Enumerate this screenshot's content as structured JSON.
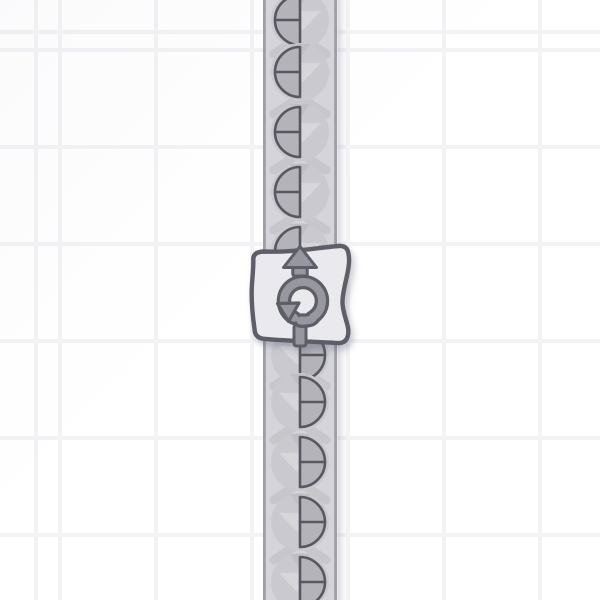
{
  "scene": {
    "kind": "factory-game-viewport",
    "grid": {
      "cell_color": "#ffffff",
      "line_color": "#f3f3f6",
      "cell_width": 96,
      "cell_height": 97,
      "line_width": 4,
      "offset_x": 58,
      "offset_y": 48
    },
    "belt": {
      "name": "conveyor-belt-vertical",
      "direction": "up",
      "x": 263,
      "width": 74,
      "fill": "#d4d4da",
      "edge_color": "#9e9ea6",
      "edge_width": 2.8,
      "shadow_side": "right",
      "shadow_color": "#5a5a6e"
    },
    "chevrons": {
      "color": "#c6c6cb",
      "ys": [
        46,
        106,
        162,
        222,
        378,
        432,
        492,
        552
      ]
    },
    "item_style": {
      "disc_color": "#c9c9cf",
      "disc_radius": 29,
      "shape_radius": 25,
      "quarter_fill": "#b3b3b9",
      "outline_color": "#585862",
      "outline_width": 2.6,
      "light_mark_color": "#d6d6db",
      "dark_mark_color": "#bfbfc5"
    },
    "items": [
      {
        "y": 20,
        "half": "left"
      },
      {
        "y": 72,
        "half": "left"
      },
      {
        "y": 132,
        "half": "left"
      },
      {
        "y": 192,
        "half": "left"
      },
      {
        "y": 252,
        "half": "left",
        "note": "partially-behind-building"
      },
      {
        "y": 355,
        "half": "right",
        "note": "partially-behind-building"
      },
      {
        "y": 402,
        "half": "right"
      },
      {
        "y": 462,
        "half": "right"
      },
      {
        "y": 522,
        "half": "right"
      },
      {
        "y": 582,
        "half": "right"
      }
    ],
    "building": {
      "name": "rotator",
      "fill": "#e9e9ee",
      "outline_color": "#5e5e68",
      "outline_width": 4.4,
      "accent_color": "#97979f",
      "icons": [
        "up-arrow-icon",
        "rotate-icon",
        "input-notch"
      ],
      "output_direction": "up",
      "input_direction": "down"
    }
  }
}
